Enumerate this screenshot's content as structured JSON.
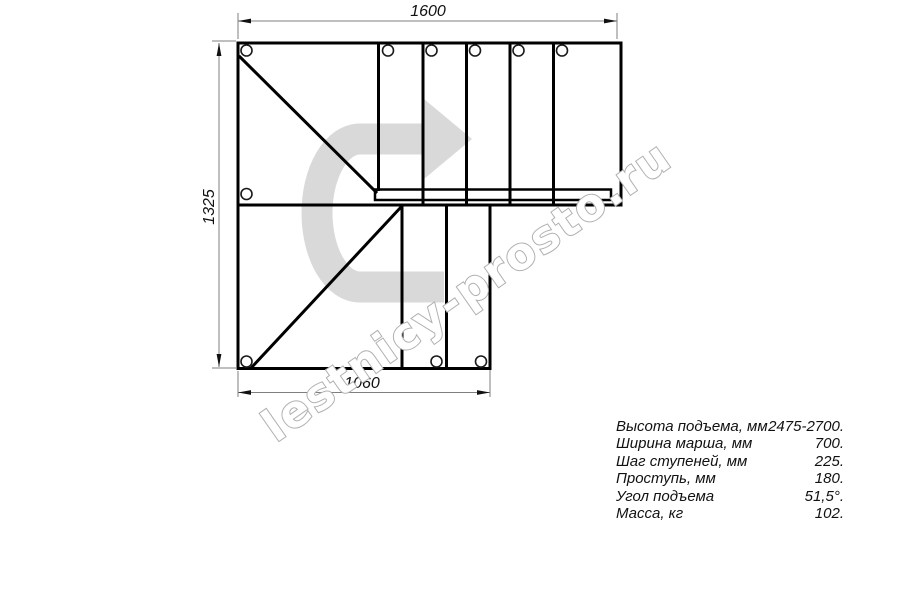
{
  "watermark": "lestnicy-prosto.ru",
  "drawing": {
    "title": "U-turn staircase plan view",
    "dim_top": "1600",
    "dim_left": "1325",
    "dim_bottom": "1060"
  },
  "specs": {
    "rows": [
      {
        "label": "Высота подъема, мм",
        "value": "2475-2700."
      },
      {
        "label": "Ширина марша, мм",
        "value": "700."
      },
      {
        "label": "Шаг ступеней, мм",
        "value": "225."
      },
      {
        "label": "Проступь, мм",
        "value": "180."
      },
      {
        "label": "Угол подъема",
        "value": "51,5°."
      },
      {
        "label": "Масса, кг",
        "value": "102."
      }
    ]
  },
  "colors": {
    "line": "#000000",
    "dimension_line": "#7f7f7f",
    "arrow_fill": "#d9d9d9",
    "watermark_outline": "#b0b0b0"
  }
}
